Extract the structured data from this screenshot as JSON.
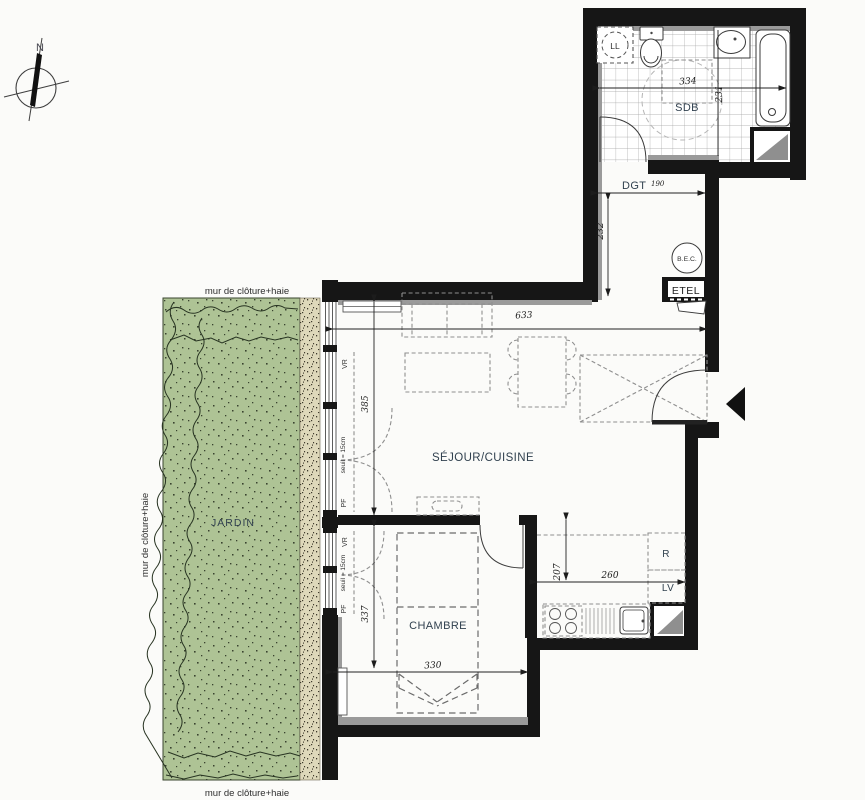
{
  "compass": {
    "north_label": "N"
  },
  "garden": {
    "label": "JARDIN",
    "wall_label_top": "mur de clôture+haie",
    "wall_label_left": "mur de clôture+haie",
    "wall_label_bottom": "mur de clôture+haie"
  },
  "bathroom": {
    "label": "SDB",
    "dim_width": "334",
    "dim_depth": "231",
    "washer_label": "LL"
  },
  "hallway": {
    "label": "DGT",
    "width_sup": "190",
    "dim_depth": "232"
  },
  "living": {
    "label": "SÉJOUR/CUISINE",
    "dim_width": "633",
    "dim_window": "385"
  },
  "bedroom": {
    "label": "CHAMBRE",
    "dim_width": "330",
    "dim_window": "337"
  },
  "kitchen": {
    "dim_width": "260",
    "dim_depth": "207",
    "fridge_label": "R",
    "dishwasher_label": "LV"
  },
  "tech": {
    "water_heater_label": "B.E.C.",
    "etel_label": "ETEL"
  },
  "window_labels": {
    "vr": "VR",
    "pf": "PF",
    "seuil": "seuil = 15cm"
  },
  "colors": {
    "wall": "#161616",
    "wall_lining": "#9a9a9a",
    "garden_green": "#aec395",
    "gravel": "#ded8ba",
    "room_label_text": "#31414f",
    "dim_text": "#1c1c1c",
    "background": "#fbfbf9"
  }
}
